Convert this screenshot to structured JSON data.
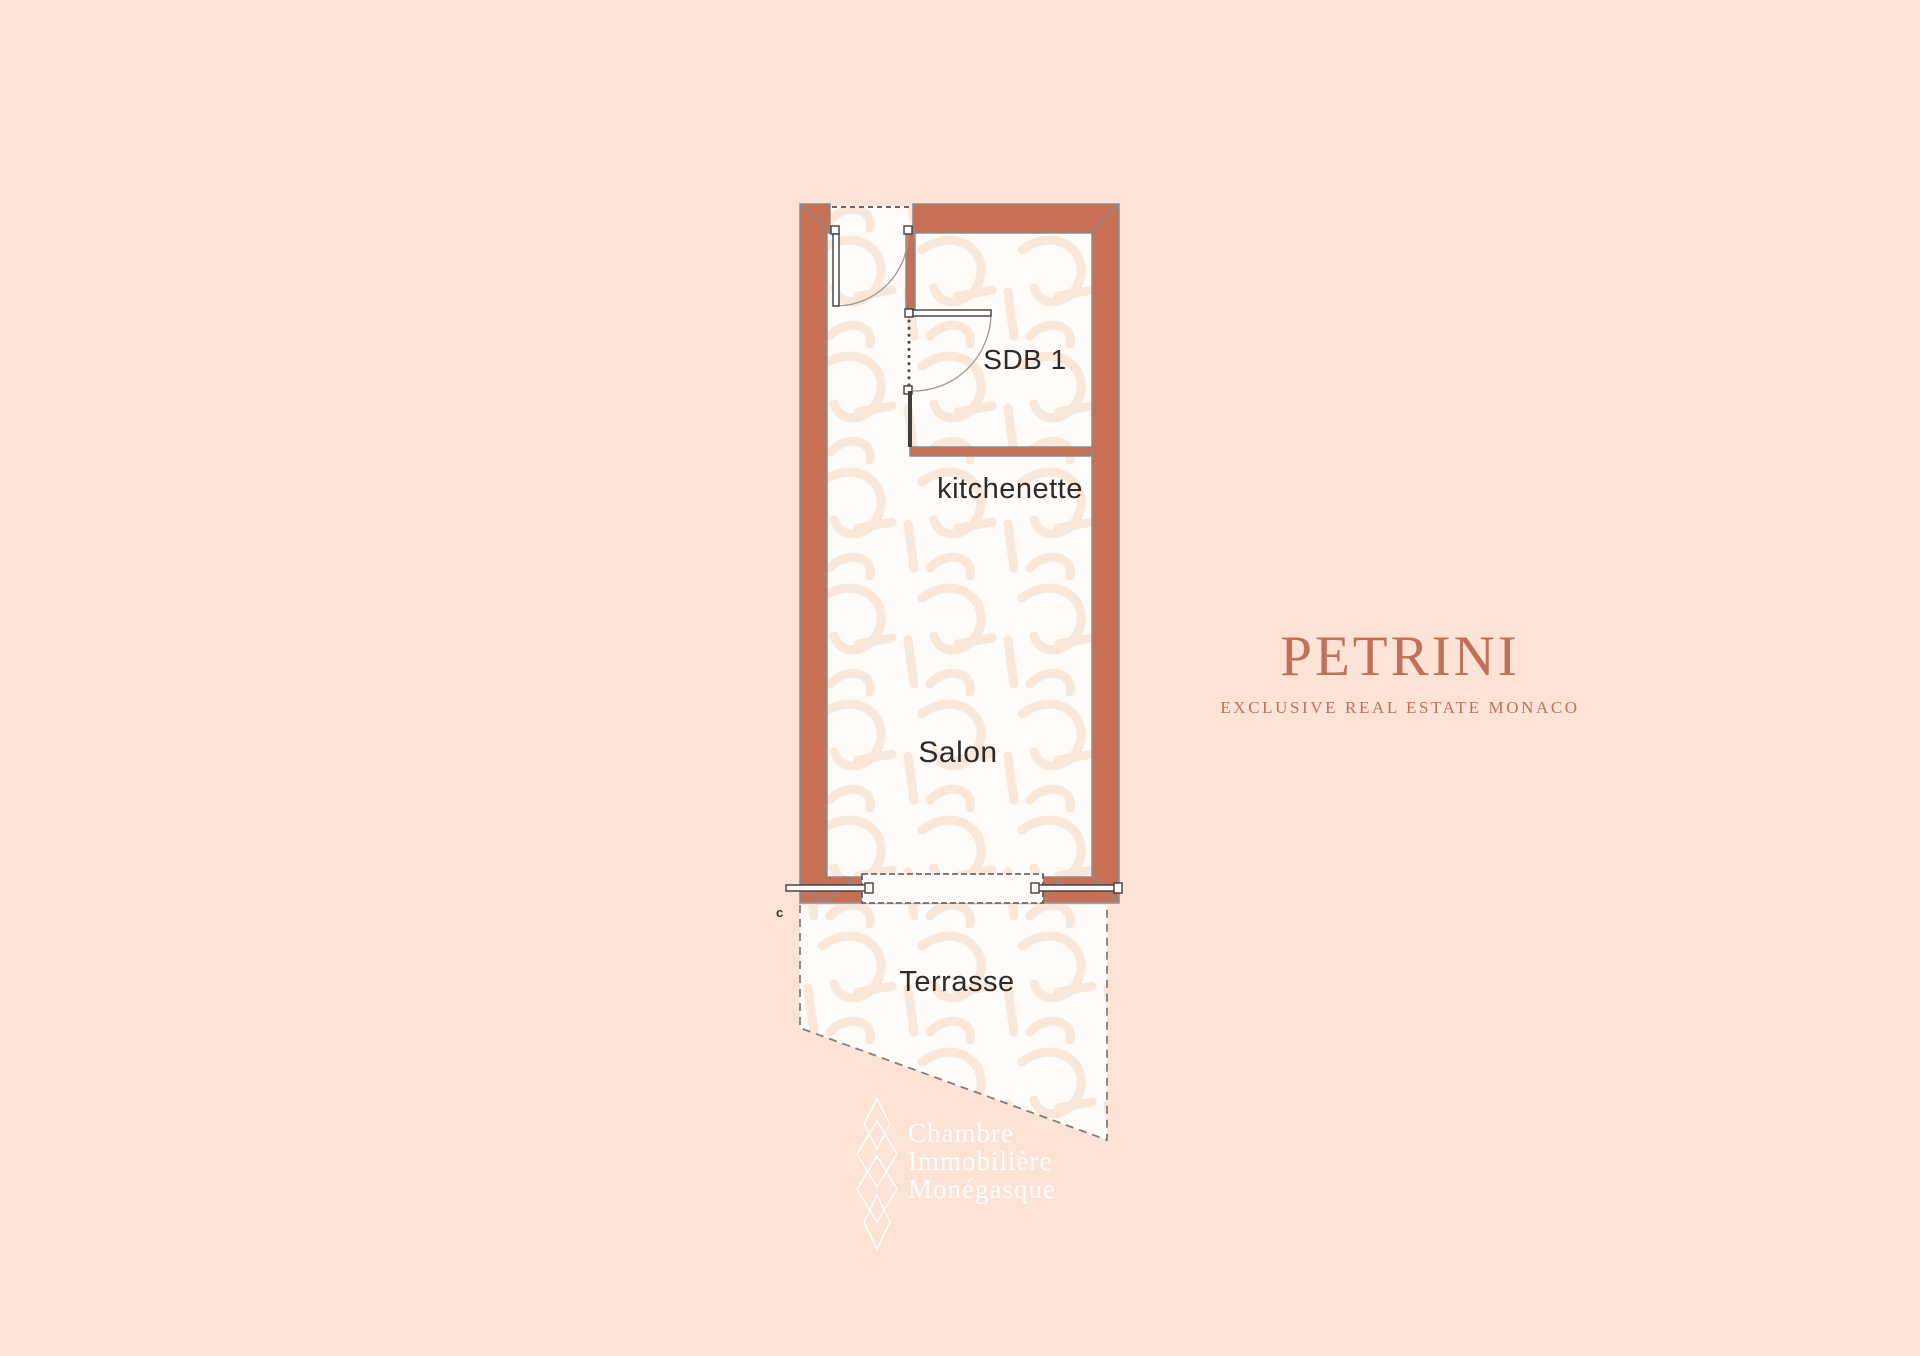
{
  "page": {
    "background_color": "#FCE3D6"
  },
  "floorplan": {
    "rooms": {
      "sdb1": "SDB 1",
      "kitchenette": "kitchenette",
      "salon": "Salon",
      "terrasse": "Terrasse"
    },
    "corner_mark": "c",
    "colors": {
      "wall": "#C77057",
      "floor": "#FEFBF8",
      "outline": "#8C8C8C",
      "door_frame": "#3F3F3F",
      "pattern": "#F9E7DA"
    }
  },
  "brand": {
    "name": "PETRINI",
    "tagline": "EXCLUSIVE REAL ESTATE MONACO",
    "color": "#C3705A"
  },
  "watermark": {
    "lines": [
      "Chambre",
      "Immobilière",
      "Monégasque"
    ],
    "color": "#FFFFFF"
  }
}
